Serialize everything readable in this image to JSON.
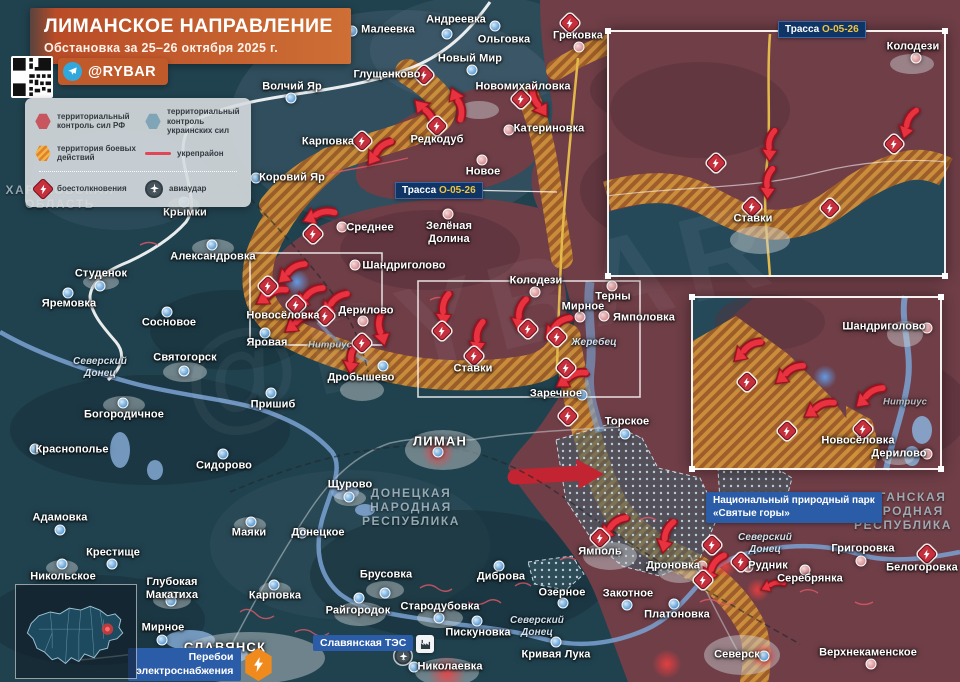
{
  "header": {
    "title": "ЛИМАНСКОЕ НАПРАВЛЕНИЕ",
    "subtitle": "Обстановка за 25–26 октября 2025 г.",
    "channel": "@RYBAR",
    "accent_color": "#CE6F35"
  },
  "legend": {
    "items": [
      {
        "icon": "hex-red-icon",
        "label": "территориальный контроль сил РФ"
      },
      {
        "icon": "hex-blue-icon",
        "label": "территориальный контроль украинских сил"
      },
      {
        "icon": "hex-hatch-icon",
        "label": "территория боевых действий"
      },
      {
        "icon": "red-line-icon",
        "label": "укрепрайон"
      },
      {
        "icon": "clash-icon",
        "label": "боестолкновения"
      },
      {
        "icon": "airstrike-icon",
        "label": "авиаудар"
      }
    ]
  },
  "badges": {
    "trassa_label": "Трасса",
    "trassa_road": "О-05-26",
    "power": "Перебои\nэлектроснабжения",
    "tes": "Славянская ТЭС",
    "park": "Национальный природный парк\n«Святые горы»"
  },
  "colors": {
    "ru_control": "#6F3E47",
    "ua_control": "#20414E",
    "combat_hatch_light": "#CF913A",
    "combat_hatch_dark": "#A05F28",
    "arrow_red": "#E8323F",
    "road_yellow": "#E3B94B",
    "river_blue": "#7BA3D4",
    "badge_blue": "#2B5CA8"
  },
  "map": {
    "places": [
      {
        "l": "Малеевка",
        "x": 388,
        "y": 30
      },
      {
        "l": "Андреевка",
        "x": 456,
        "y": 20
      },
      {
        "l": "Ольговка",
        "x": 504,
        "y": 40
      },
      {
        "l": "Новый Мир",
        "x": 470,
        "y": 59
      },
      {
        "l": "Грековка",
        "x": 578,
        "y": 36
      },
      {
        "l": "Волчий Яр",
        "x": 292,
        "y": 87
      },
      {
        "l": "Глущенково",
        "x": 387,
        "y": 75
      },
      {
        "l": "Новомихайловка",
        "x": 523,
        "y": 87
      },
      {
        "l": "Катериновка",
        "x": 549,
        "y": 129
      },
      {
        "l": "Редкодуб",
        "x": 437,
        "y": 140
      },
      {
        "l": "Карповка",
        "x": 328,
        "y": 142
      },
      {
        "l": "Коровий Яр",
        "x": 292,
        "y": 178
      },
      {
        "l": "Крымки",
        "x": 185,
        "y": 213
      },
      {
        "l": "Александровка",
        "x": 213,
        "y": 257
      },
      {
        "l": "Среднее",
        "x": 370,
        "y": 228
      },
      {
        "l": "Новое",
        "x": 483,
        "y": 172
      },
      {
        "l": "Зелёная\nДолина",
        "x": 449,
        "y": 233
      },
      {
        "l": "Шандриголово",
        "x": 404,
        "y": 266
      },
      {
        "l": "Колодези",
        "x": 536,
        "y": 281
      },
      {
        "l": "Терны",
        "x": 613,
        "y": 297
      },
      {
        "l": "Мирное",
        "x": 583,
        "y": 307
      },
      {
        "l": "Ямполовка",
        "x": 644,
        "y": 318
      },
      {
        "l": "Новосёловка",
        "x": 283,
        "y": 316
      },
      {
        "l": "Дерилово",
        "x": 366,
        "y": 311
      },
      {
        "l": "Яровая",
        "x": 267,
        "y": 343
      },
      {
        "l": "Дробышево",
        "x": 361,
        "y": 378
      },
      {
        "l": "Ставки",
        "x": 473,
        "y": 369
      },
      {
        "l": "Заречное",
        "x": 556,
        "y": 394
      },
      {
        "l": "Торское",
        "x": 627,
        "y": 422
      },
      {
        "l": "Пришиб",
        "x": 273,
        "y": 405
      },
      {
        "l": "Святогорск",
        "x": 185,
        "y": 358
      },
      {
        "l": "Сосновое",
        "x": 169,
        "y": 323
      },
      {
        "l": "Студенок",
        "x": 101,
        "y": 274
      },
      {
        "l": "Яремовка",
        "x": 69,
        "y": 304
      },
      {
        "l": "Богородичное",
        "x": 124,
        "y": 415
      },
      {
        "l": "Краснополье",
        "x": 72,
        "y": 450
      },
      {
        "l": "Сидорово",
        "x": 224,
        "y": 466
      },
      {
        "l": "Адамовка",
        "x": 60,
        "y": 518
      },
      {
        "l": "Маяки",
        "x": 249,
        "y": 533
      },
      {
        "l": "ЛИМАН",
        "x": 440,
        "y": 441,
        "c": "caps"
      },
      {
        "l": "Щурово",
        "x": 350,
        "y": 485
      },
      {
        "l": "Донецкое",
        "x": 318,
        "y": 533
      },
      {
        "l": "Никольское",
        "x": 63,
        "y": 577
      },
      {
        "l": "Крестище",
        "x": 113,
        "y": 553
      },
      {
        "l": "Глубокая\nМакатиха",
        "x": 172,
        "y": 589
      },
      {
        "l": "Карповка",
        "x": 275,
        "y": 596
      },
      {
        "l": "Мирное",
        "x": 163,
        "y": 628
      },
      {
        "l": "СЛАВЯНСК",
        "x": 225,
        "y": 647,
        "c": "caps"
      },
      {
        "l": "Брусовка",
        "x": 386,
        "y": 575
      },
      {
        "l": "Диброва",
        "x": 501,
        "y": 577
      },
      {
        "l": "Озерное",
        "x": 562,
        "y": 593
      },
      {
        "l": "Райгородок",
        "x": 358,
        "y": 611
      },
      {
        "l": "Стародубовка",
        "x": 440,
        "y": 607
      },
      {
        "l": "Пискуновка",
        "x": 478,
        "y": 633
      },
      {
        "l": "Кривая Лука",
        "x": 556,
        "y": 655
      },
      {
        "l": "Закотное",
        "x": 628,
        "y": 594
      },
      {
        "l": "Ямполь",
        "x": 600,
        "y": 552
      },
      {
        "l": "Дроновка",
        "x": 673,
        "y": 566
      },
      {
        "l": "Рудник",
        "x": 768,
        "y": 566
      },
      {
        "l": "Серебрянка",
        "x": 810,
        "y": 579
      },
      {
        "l": "Григоровка",
        "x": 863,
        "y": 549
      },
      {
        "l": "Белогоровка",
        "x": 922,
        "y": 568
      },
      {
        "l": "Платоновка",
        "x": 677,
        "y": 615
      },
      {
        "l": "Северск",
        "x": 737,
        "y": 655
      },
      {
        "l": "Верхнекаменское",
        "x": 868,
        "y": 653
      },
      {
        "l": "Николаевка",
        "x": 450,
        "y": 667
      },
      {
        "l": "ХАРЬКОВСКАЯ\nОБЛАСТЬ",
        "x": 60,
        "y": 197,
        "c": "region"
      },
      {
        "l": "ДОНЕЦКАЯ\nНАРОДНАЯ\nРЕСПУБЛИКА",
        "x": 411,
        "y": 507,
        "c": "region"
      },
      {
        "l": "ЛУГАНСКАЯ\nНАРОДНАЯ\nРЕСПУБЛИКА",
        "x": 903,
        "y": 511,
        "c": "region"
      },
      {
        "l": "Северский\nДонец",
        "x": 100,
        "y": 368,
        "c": "river"
      },
      {
        "l": "Северский\nДонец",
        "x": 537,
        "y": 627,
        "c": "river"
      },
      {
        "l": "Северский\nДонец",
        "x": 765,
        "y": 544,
        "c": "river"
      },
      {
        "l": "Жеребец",
        "x": 594,
        "y": 343,
        "c": "river"
      },
      {
        "l": "Нитриус",
        "x": 330,
        "y": 345,
        "c": "riverg"
      },
      {
        "l": "Колодези",
        "x": 913,
        "y": 47
      },
      {
        "l": "Ставки",
        "x": 753,
        "y": 219
      },
      {
        "l": "Шандриголово",
        "x": 884,
        "y": 327
      },
      {
        "l": "Новосёловка",
        "x": 858,
        "y": 441
      },
      {
        "l": "Дерилово",
        "x": 899,
        "y": 454
      },
      {
        "l": "Нитриус",
        "x": 905,
        "y": 402,
        "c": "riverg"
      }
    ],
    "dots": [
      [
        352,
        31,
        "ua"
      ],
      [
        447,
        34,
        "ua"
      ],
      [
        495,
        26,
        "ua"
      ],
      [
        472,
        70,
        "ua"
      ],
      [
        291,
        98,
        "ua"
      ],
      [
        256,
        178,
        "ua"
      ],
      [
        184,
        202,
        "ua"
      ],
      [
        212,
        245,
        "ua"
      ],
      [
        265,
        333,
        "ua"
      ],
      [
        383,
        366,
        "ua"
      ],
      [
        582,
        395,
        "ua"
      ],
      [
        625,
        434,
        "ua"
      ],
      [
        271,
        393,
        "ua"
      ],
      [
        184,
        371,
        "ua"
      ],
      [
        167,
        312,
        "ua"
      ],
      [
        100,
        286,
        "ua"
      ],
      [
        68,
        293,
        "ua"
      ],
      [
        123,
        403,
        "ua"
      ],
      [
        35,
        449,
        "ua"
      ],
      [
        223,
        454,
        "ua"
      ],
      [
        60,
        530,
        "ua"
      ],
      [
        251,
        522,
        "ua"
      ],
      [
        349,
        497,
        "ua"
      ],
      [
        302,
        533,
        "ua"
      ],
      [
        62,
        564,
        "ua"
      ],
      [
        112,
        564,
        "ua"
      ],
      [
        171,
        601,
        "ua"
      ],
      [
        274,
        585,
        "ua"
      ],
      [
        162,
        640,
        "ua"
      ],
      [
        385,
        593,
        "ua"
      ],
      [
        499,
        566,
        "ua"
      ],
      [
        563,
        603,
        "ua"
      ],
      [
        359,
        598,
        "ua"
      ],
      [
        439,
        618,
        "ua"
      ],
      [
        477,
        621,
        "ua"
      ],
      [
        556,
        642,
        "ua"
      ],
      [
        627,
        605,
        "ua"
      ],
      [
        674,
        604,
        "ua"
      ],
      [
        414,
        667,
        "ua"
      ],
      [
        438,
        452,
        "ua"
      ],
      [
        764,
        656,
        "ua"
      ],
      [
        579,
        47,
        "ru"
      ],
      [
        509,
        130,
        "ru"
      ],
      [
        342,
        227,
        "ru"
      ],
      [
        482,
        160,
        "ru"
      ],
      [
        448,
        214,
        "ru"
      ],
      [
        355,
        265,
        "ru"
      ],
      [
        535,
        292,
        "ru"
      ],
      [
        612,
        286,
        "ru"
      ],
      [
        580,
        317,
        "ru"
      ],
      [
        604,
        316,
        "ru"
      ],
      [
        363,
        321,
        "ru"
      ],
      [
        702,
        566,
        "ru"
      ],
      [
        748,
        567,
        "ru"
      ],
      [
        805,
        570,
        "ru"
      ],
      [
        861,
        561,
        "ru"
      ],
      [
        871,
        664,
        "ru"
      ],
      [
        916,
        58,
        "ru"
      ],
      [
        927,
        328,
        "ru"
      ],
      [
        927,
        454,
        "ru"
      ]
    ],
    "bolts": [
      [
        424,
        75
      ],
      [
        521,
        99
      ],
      [
        570,
        23
      ],
      [
        437,
        126
      ],
      [
        362,
        141
      ],
      [
        313,
        234
      ],
      [
        268,
        286
      ],
      [
        296,
        305
      ],
      [
        325,
        316
      ],
      [
        362,
        343
      ],
      [
        442,
        331
      ],
      [
        474,
        356
      ],
      [
        528,
        329
      ],
      [
        557,
        337
      ],
      [
        566,
        368
      ],
      [
        568,
        416
      ],
      [
        600,
        538
      ],
      [
        712,
        545
      ],
      [
        703,
        580
      ],
      [
        741,
        562
      ],
      [
        927,
        554
      ],
      [
        716,
        163
      ],
      [
        894,
        144
      ],
      [
        830,
        208
      ],
      [
        752,
        207
      ],
      [
        747,
        382
      ],
      [
        787,
        431
      ],
      [
        863,
        429
      ]
    ],
    "arrows": [
      [
        318,
        215,
        65
      ],
      [
        290,
        272,
        45
      ],
      [
        270,
        295,
        55
      ],
      [
        308,
        296,
        45
      ],
      [
        333,
        303,
        40
      ],
      [
        298,
        322,
        50
      ],
      [
        381,
        330,
        -15
      ],
      [
        352,
        358,
        5
      ],
      [
        444,
        310,
        0
      ],
      [
        478,
        338,
        0
      ],
      [
        520,
        315,
        5
      ],
      [
        556,
        327,
        40
      ],
      [
        570,
        378,
        55
      ],
      [
        612,
        527,
        40
      ],
      [
        666,
        537,
        10
      ],
      [
        713,
        568,
        25
      ],
      [
        772,
        585,
        65,
        0.7
      ],
      [
        426,
        112,
        135
      ],
      [
        458,
        103,
        155
      ],
      [
        538,
        103,
        -35
      ],
      [
        378,
        152,
        35
      ],
      [
        770,
        146,
        0,
        0.9
      ],
      [
        768,
        184,
        0,
        0.9
      ],
      [
        908,
        124,
        15,
        0.9
      ],
      [
        746,
        350,
        45
      ],
      [
        788,
        373,
        48
      ],
      [
        818,
        408,
        55
      ],
      [
        868,
        396,
        45
      ]
    ],
    "glows": [
      [
        438,
        452,
        17,
        "red"
      ],
      [
        447,
        674,
        19,
        "red"
      ],
      [
        764,
        656,
        14,
        "red"
      ],
      [
        725,
        566,
        12,
        "red"
      ],
      [
        758,
        590,
        12,
        "red"
      ],
      [
        667,
        664,
        15,
        "red"
      ],
      [
        297,
        282,
        13,
        "blue"
      ],
      [
        825,
        377,
        12,
        "blue"
      ]
    ]
  }
}
